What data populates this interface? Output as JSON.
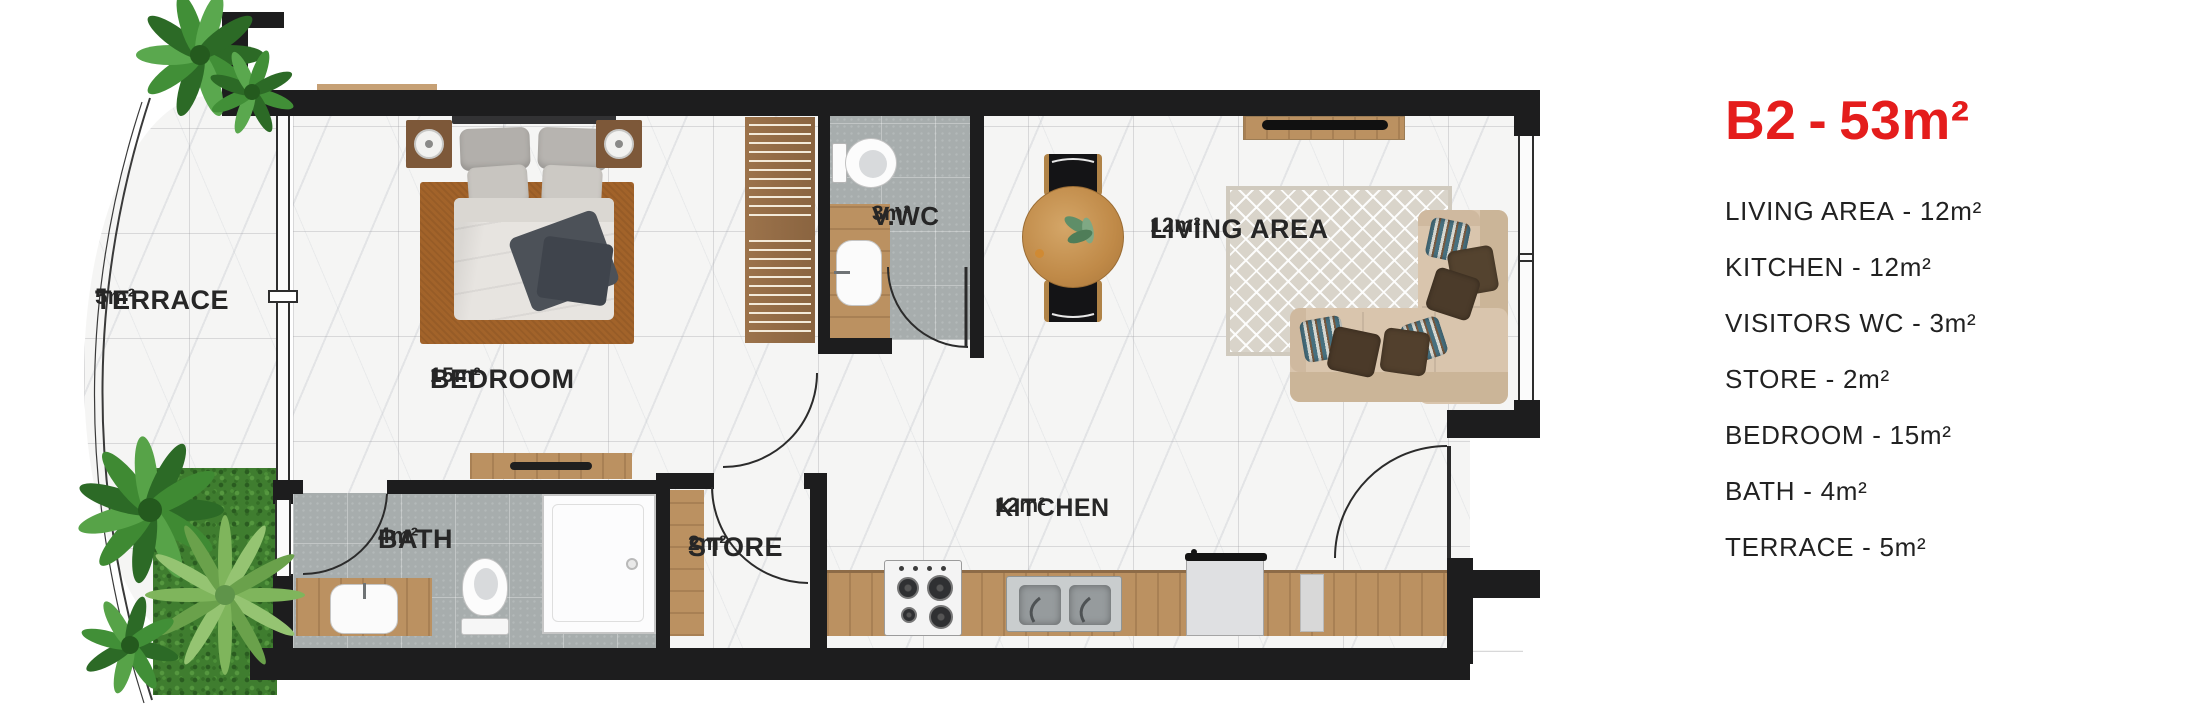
{
  "plan": {
    "rooms": {
      "terrace": {
        "name": "TERRACE",
        "area": "5m²"
      },
      "bedroom": {
        "name": "BEDROOM",
        "area": "15m²"
      },
      "bath": {
        "name": "BATH",
        "area": "4m²"
      },
      "store": {
        "name": "STORE",
        "area": "2m²"
      },
      "visitors_wc": {
        "name": "V.WC",
        "area": "3m²"
      },
      "kitchen": {
        "name": "KITCHEN",
        "area": "12m²"
      },
      "living": {
        "name": "LIVING AREA",
        "area": "12m²"
      }
    }
  },
  "legend": {
    "title": {
      "code": "B2",
      "separator": "-",
      "area": "53m²"
    },
    "separator": "-",
    "items": [
      {
        "label": "LIVING AREA",
        "area": "12m²"
      },
      {
        "label": "KITCHEN",
        "area": "12m²"
      },
      {
        "label": "VISITORS WC",
        "area": "3m²"
      },
      {
        "label": "STORE",
        "area": "2m²"
      },
      {
        "label": "BEDROOM",
        "area": "15m²"
      },
      {
        "label": "BATH",
        "area": "4m²"
      },
      {
        "label": "TERRACE",
        "area": "5m²"
      }
    ]
  },
  "colors": {
    "accent_red": "#e41d1c",
    "wall": "#1d1d1e"
  }
}
